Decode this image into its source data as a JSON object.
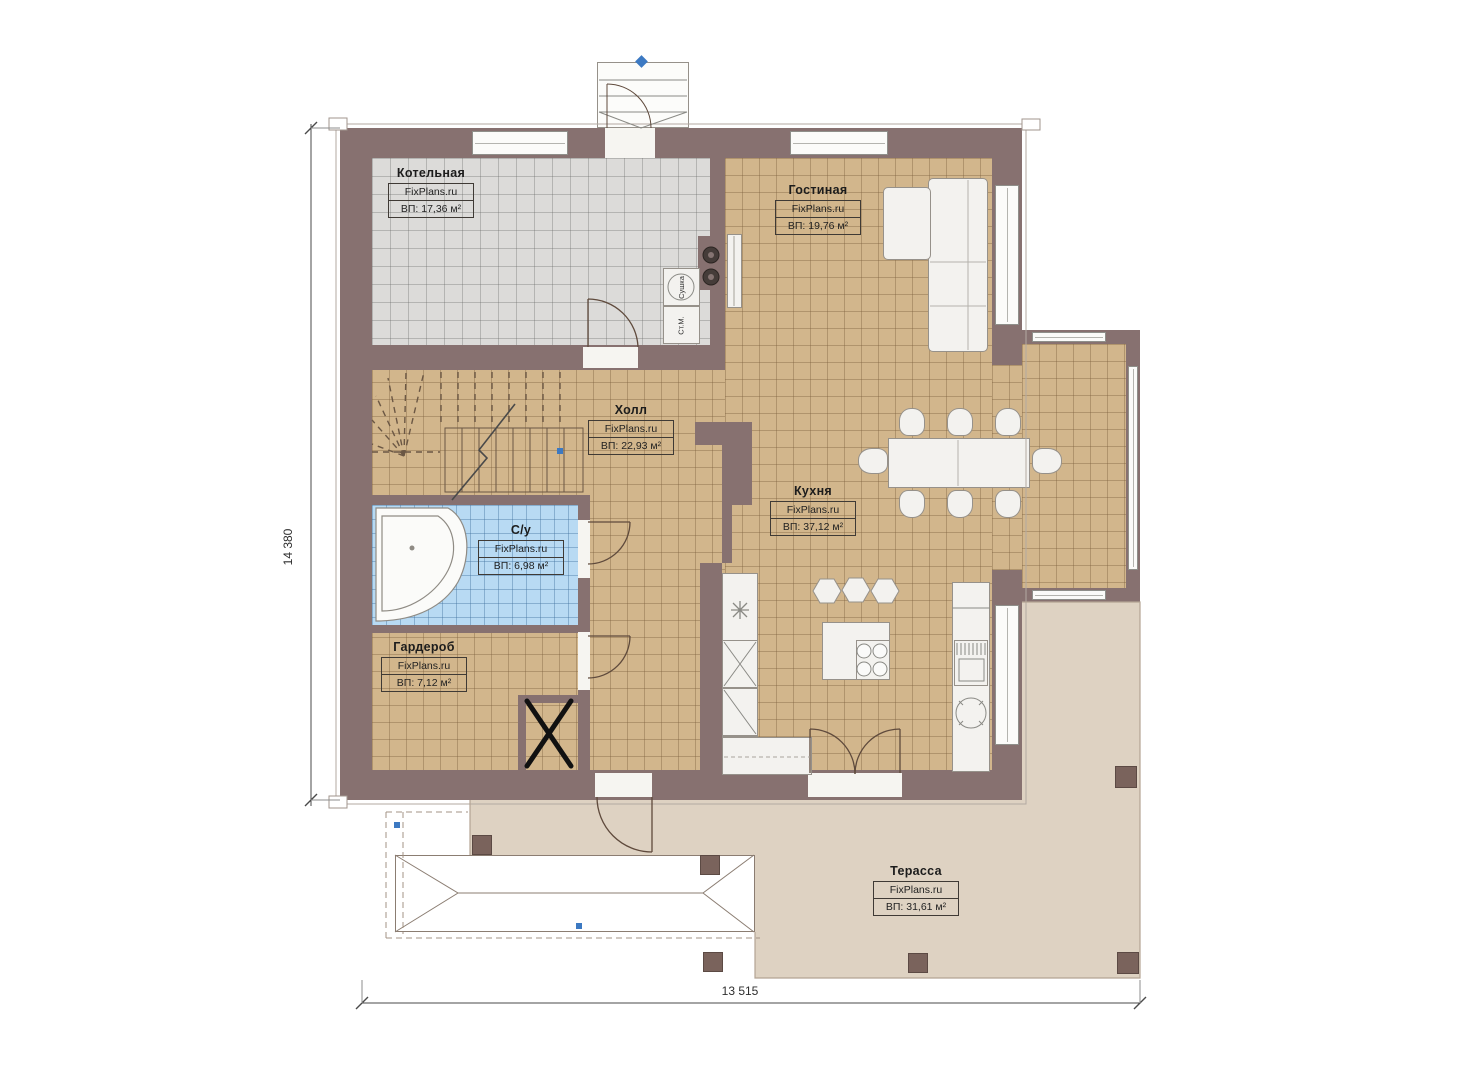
{
  "plan": {
    "rooms": [
      {
        "key": "boiler",
        "name": "Котельная",
        "brand": "FixPlans.ru",
        "area": "ВП: 17,36 м²"
      },
      {
        "key": "living",
        "name": "Гостиная",
        "brand": "FixPlans.ru",
        "area": "ВП: 19,76 м²"
      },
      {
        "key": "hall",
        "name": "Холл",
        "brand": "FixPlans.ru",
        "area": "ВП: 22,93 м²"
      },
      {
        "key": "kitchen",
        "name": "Кухня",
        "brand": "FixPlans.ru",
        "area": "ВП: 37,12 м²"
      },
      {
        "key": "bathroom",
        "name": "С/у",
        "brand": "FixPlans.ru",
        "area": "ВП: 6,98 м²"
      },
      {
        "key": "wardrobe",
        "name": "Гардероб",
        "brand": "FixPlans.ru",
        "area": "ВП: 7,12 м²"
      },
      {
        "key": "terrace",
        "name": "Терасса",
        "brand": "FixPlans.ru",
        "area": "ВП: 31,61 м²"
      }
    ],
    "appliance_labels": {
      "washing_machine": "Ст.М.",
      "dryer": "Сушка"
    },
    "dimensions": {
      "height": "14 380",
      "width": "13 515"
    },
    "colors": {
      "wall": "#877170",
      "floor_tile": "#d2b68c",
      "boiler_tile": "#dcdbd9",
      "bath_tile": "#b8daf3",
      "terrace": "#ded2c2",
      "column": "#7a635c",
      "handle_accent": "#3c79c2"
    }
  }
}
